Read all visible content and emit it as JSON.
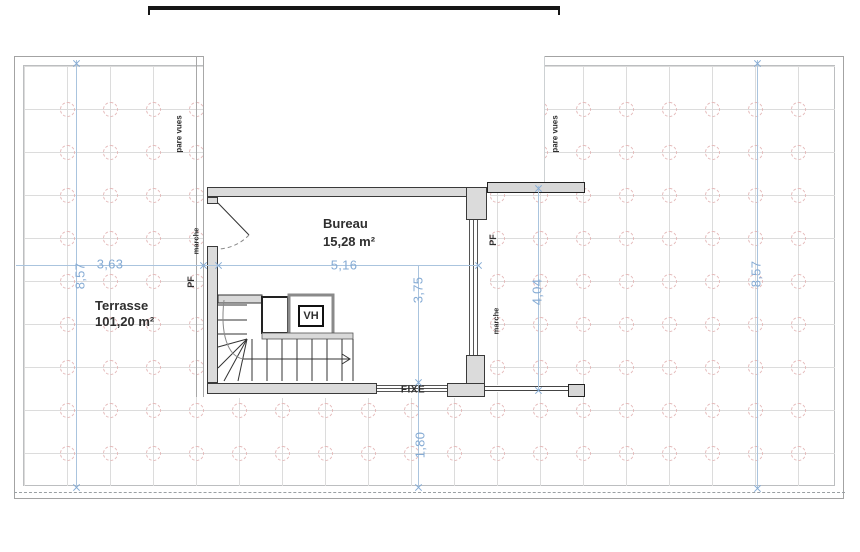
{
  "rooms": {
    "terrasse": {
      "name": "Terrasse",
      "area": "101,20 m²"
    },
    "bureau": {
      "name": "Bureau",
      "area": "15,28 m²"
    }
  },
  "dimensions": {
    "terrace_height_left": "8,57",
    "terrace_width_left": "3,63",
    "bureau_width": "5,16",
    "bureau_depth": "3,75",
    "right_section_height": "4,04",
    "bottom_offset": "1,80",
    "terrace_height_right": "8,57"
  },
  "annotations": {
    "pare_vues_left": "pare vues",
    "pare_vues_right": "pare vues",
    "marche_left": "marche",
    "marche_right": "marche",
    "pf_left": "PF",
    "pf_right": "PF",
    "fixe": "FIXE",
    "vh": "VH"
  },
  "colors": {
    "dimension_blue": "#85abd4",
    "grid_line": "#dcdcdc",
    "grid_circle_pink": "#e4b9b9",
    "wall_fill": "#dbdbdb",
    "wall_edge": "#3a3a3a",
    "text_dark": "#2f2f2f"
  }
}
